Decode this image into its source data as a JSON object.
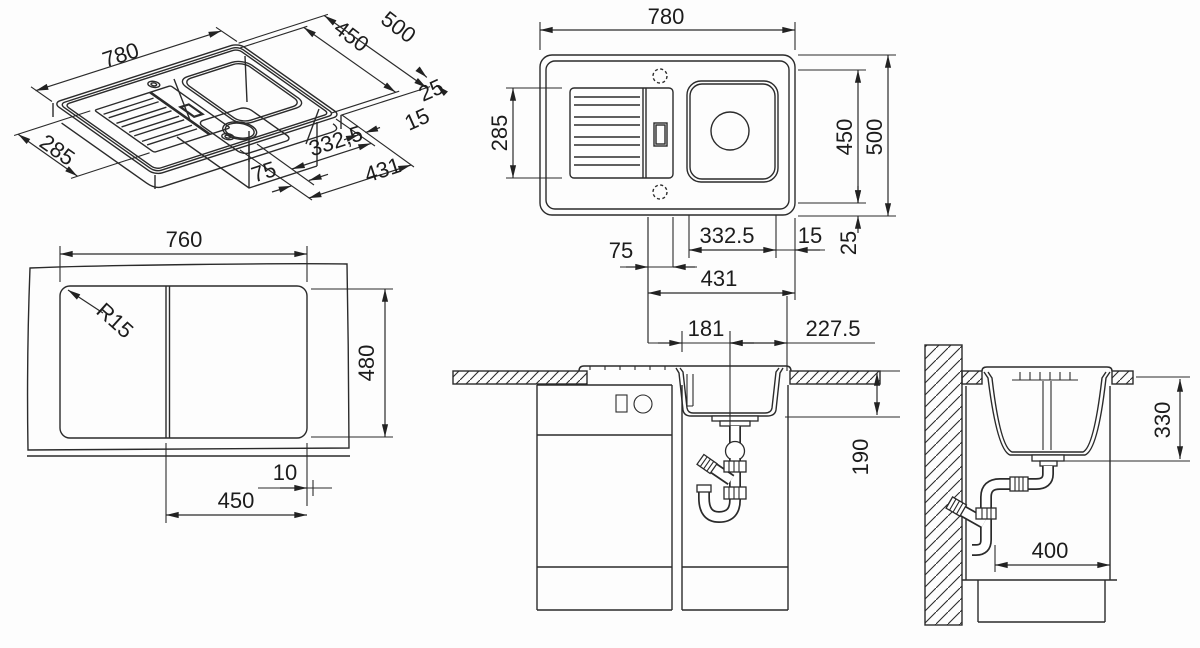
{
  "drawing": {
    "title": "sink-technical-drawing",
    "iso": {
      "length": "780",
      "width": "500",
      "inner_width": "450",
      "rim_back": "25",
      "rim_edge": "15",
      "board_width": "285",
      "bowl_length": "332,5",
      "divider": "75",
      "bowl_section": "431"
    },
    "top": {
      "length": "780",
      "board_width": "285",
      "inner_width": "450",
      "width": "500",
      "bowl_length": "332.5",
      "edge": "15",
      "rim": "25",
      "divider": "75",
      "bowl_section": "431"
    },
    "cutout": {
      "width": "760",
      "corner_radius": "R15",
      "height": "480",
      "offset": "10",
      "bowl_cut": "450"
    },
    "front": {
      "drain_left": "181",
      "drain_right": "227.5",
      "bowl_depth": "190"
    },
    "side": {
      "clearance": "330",
      "base_depth": "400"
    }
  }
}
